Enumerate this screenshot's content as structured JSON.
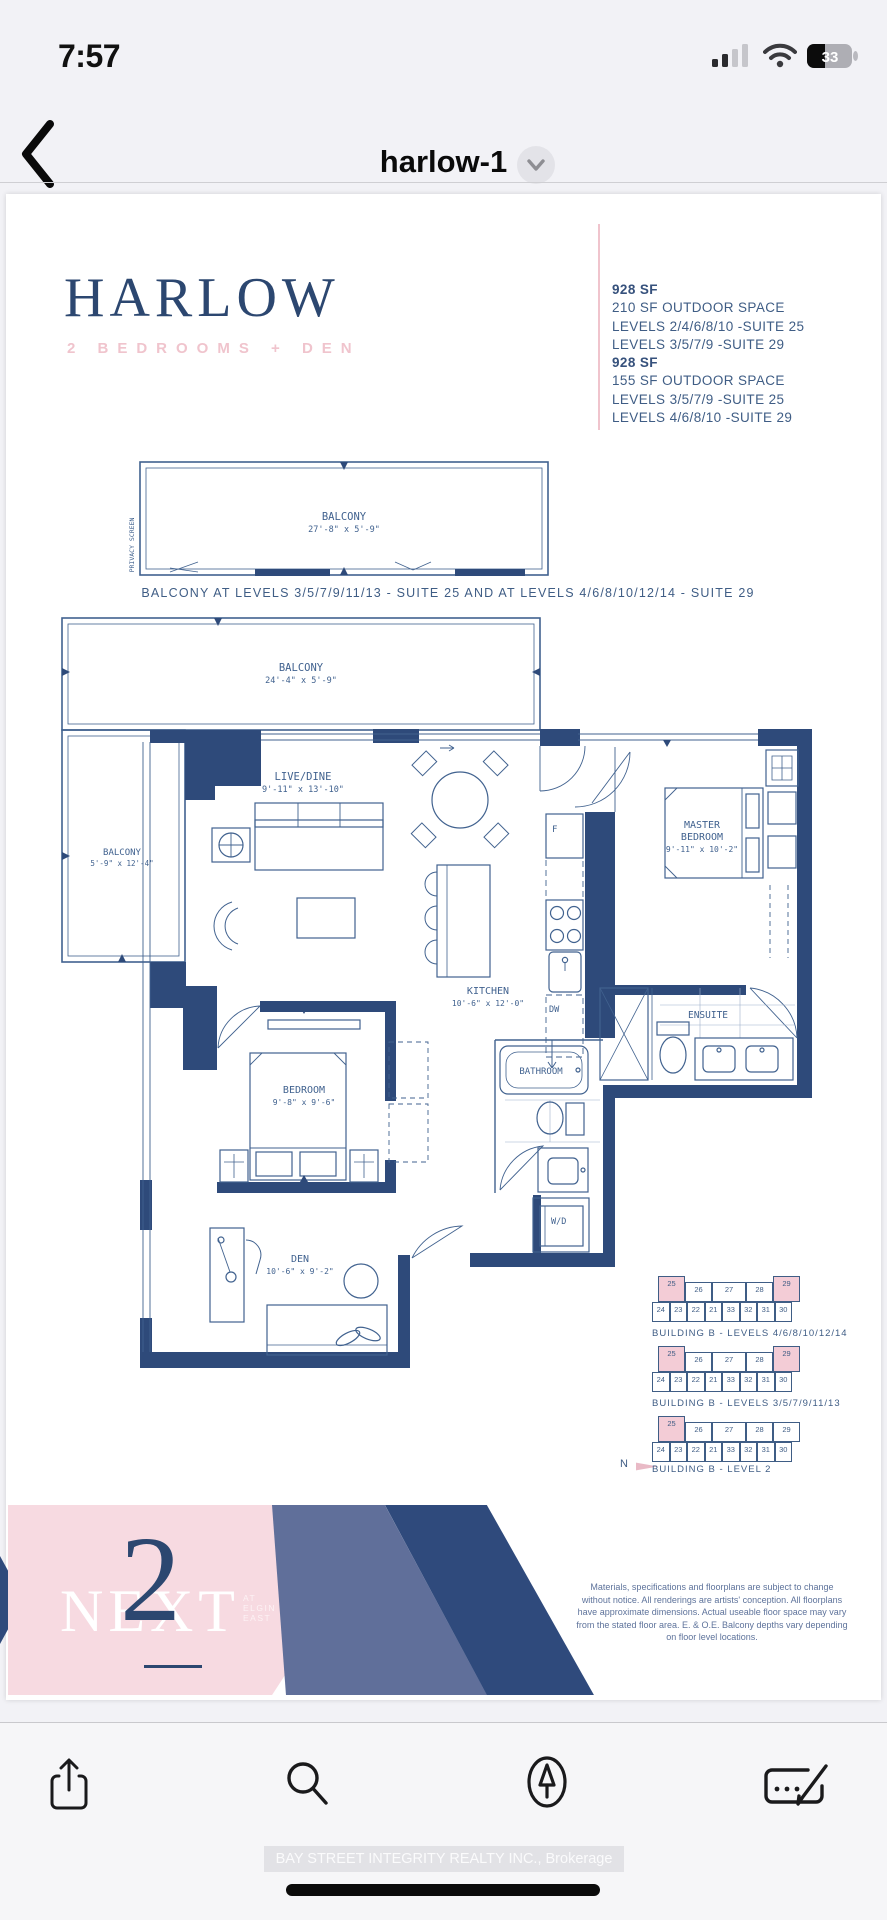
{
  "colors": {
    "navy": "#2e4a7a",
    "pink": "#f3ccd6",
    "spec_text": "#3f5d85",
    "logo_pink": "#f7dae1"
  },
  "status_bar": {
    "time": "7:57",
    "battery": "33"
  },
  "nav": {
    "title": "harlow-1"
  },
  "doc": {
    "title": "HARLOW",
    "subtitle": "2 BEDROOMS + DEN",
    "specs": [
      "928 SF",
      "210 SF OUTDOOR SPACE",
      "LEVELS 2/4/6/8/10 -SUITE 25",
      "LEVELS 3/5/7/9 -SUITE 29",
      "928 SF",
      "155 SF OUTDOOR SPACE",
      "LEVELS 3/5/7/9 -SUITE 25",
      "LEVELS 4/6/8/10 -SUITE 29"
    ],
    "balcony_caption": "BALCONY AT LEVELS 3/5/7/9/11/13 - SUITE 25 AND AT LEVELS 4/6/8/10/12/14 - SUITE 29",
    "plan": {
      "balcony_strip": {
        "name": "BALCONY",
        "dims": "27'-8\" x 5'-9\"",
        "privacy": "PRIVACY SCREEN"
      },
      "balcony_top": {
        "name": "BALCONY",
        "dims": "24'-4\" x 5'-9\""
      },
      "balcony_side": {
        "name": "BALCONY",
        "dims": "5'-9\" x 12'-4\""
      },
      "live_dine": {
        "name": "LIVE/DINE",
        "dims": "9'-11\" x 13'-10\""
      },
      "master": {
        "line1": "MASTER",
        "line2": "BEDROOM",
        "dims": "9'-11\" x 10'-2\""
      },
      "kitchen": {
        "name": "KITCHEN",
        "dims": "10'-6\" x 12'-0\""
      },
      "bedroom": {
        "name": "BEDROOM",
        "dims": "9'-8\" x 9'-6\""
      },
      "bathroom": {
        "name": "BATHROOM"
      },
      "ensuite": {
        "name": "ENSUITE"
      },
      "den": {
        "name": "DEN",
        "dims": "10'-6\" x 9'-2\""
      },
      "wd": "W/D",
      "fridge": "F",
      "dishwasher": "DW"
    },
    "keyplans": [
      {
        "caption": "BUILDING B - LEVELS 4/6/8/10/12/14",
        "top": [
          "25",
          "26",
          "27",
          "28",
          "29"
        ],
        "bottom": [
          "24",
          "23",
          "22",
          "21",
          "33",
          "32",
          "31",
          "30"
        ]
      },
      {
        "caption": "BUILDING B - LEVELS 3/5/7/9/11/13",
        "top": [
          "25",
          "26",
          "27",
          "28",
          "29"
        ],
        "bottom": [
          "24",
          "23",
          "22",
          "21",
          "33",
          "32",
          "31",
          "30"
        ]
      },
      {
        "caption": "BUILDING B - LEVEL 2",
        "top": [
          "25",
          "26",
          "27",
          "28",
          "29"
        ],
        "bottom": [
          "24",
          "23",
          "22",
          "21",
          "33",
          "32",
          "31",
          "30"
        ]
      }
    ],
    "north": "N",
    "brand": {
      "name": "NEXT",
      "numeral": "2",
      "tagline": [
        "AT",
        "ELGIN",
        "EAST"
      ]
    },
    "disclaimer": "Materials, specifications and floorplans are subject to change without notice. All renderings are artists' conception. All floorplans have approximate dimensions. Actual useable floor space may vary from the stated floor area. E. & O.E. Balcony depths vary depending on floor level locations."
  },
  "watermark": "BAY STREET INTEGRITY REALTY INC., Brokerage"
}
